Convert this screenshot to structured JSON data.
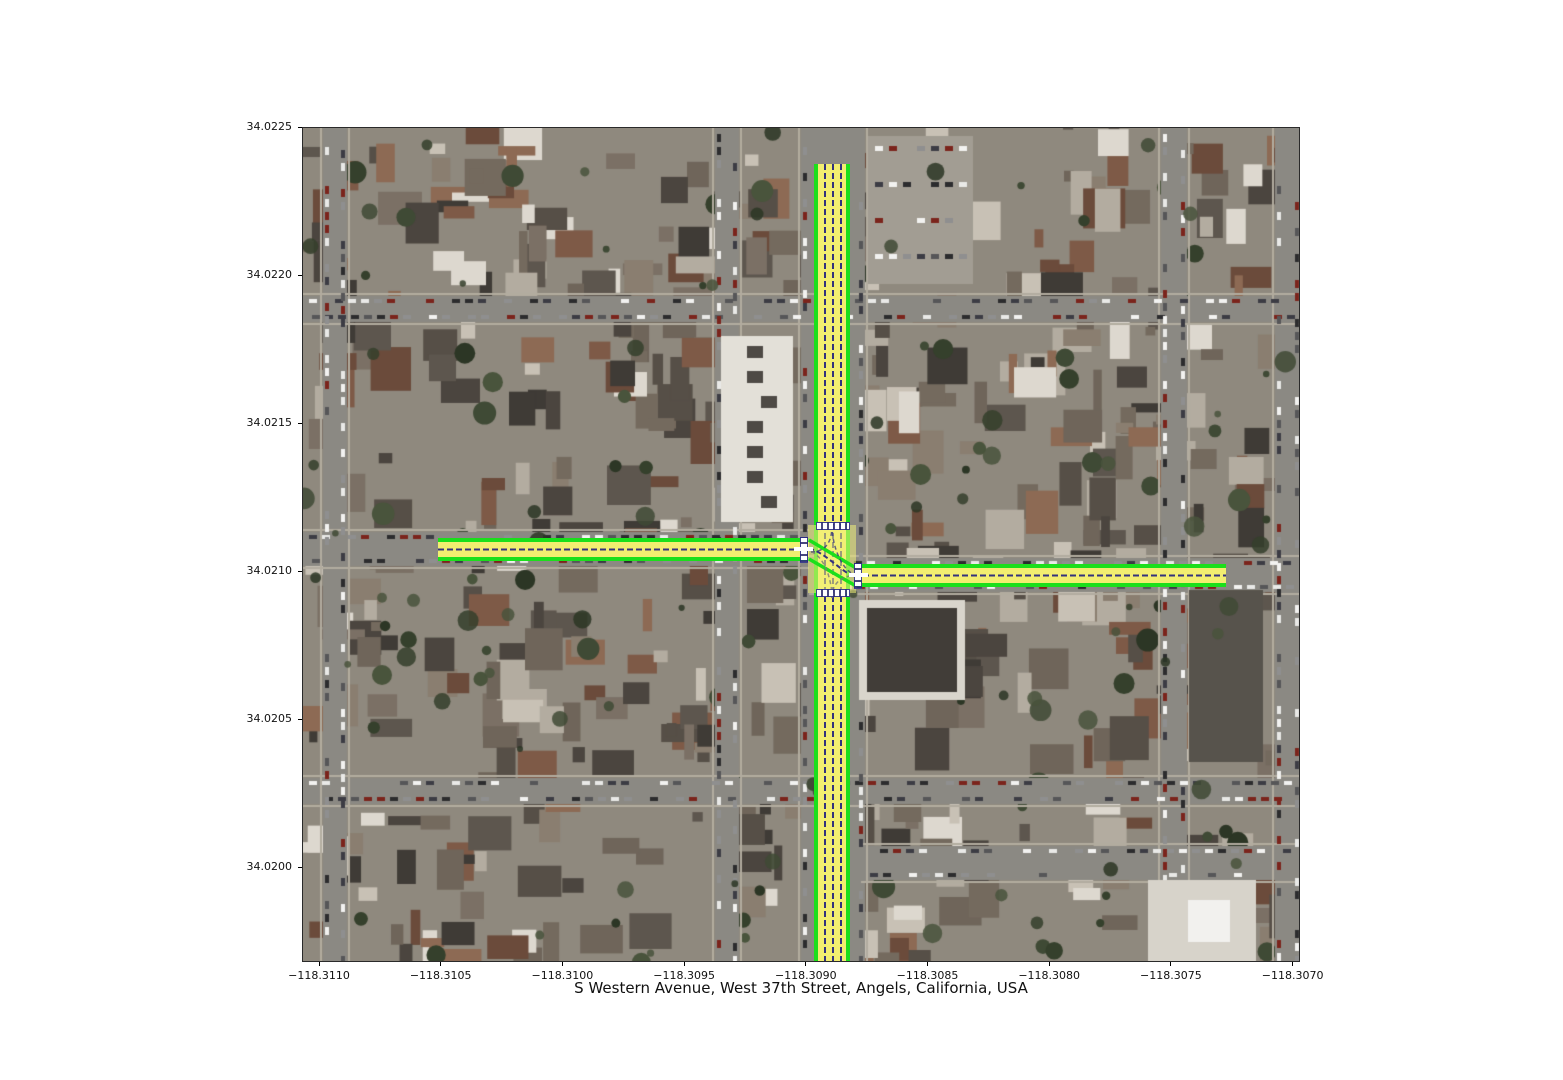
{
  "figure": {
    "title": "S Western Avenue, West 37th Street, Angels, California, USA",
    "x_axis": {
      "ticks": [
        "−118.3110",
        "−118.3105",
        "−118.3100",
        "−118.3095",
        "−118.3090",
        "−118.3085",
        "−118.3080",
        "−118.3075",
        "−118.3070"
      ],
      "range": [
        -118.31107,
        -118.30697
      ]
    },
    "y_axis": {
      "ticks": [
        "34.0225",
        "34.0220",
        "34.0215",
        "34.0210",
        "34.0205",
        "34.0200"
      ],
      "range": [
        34.01968,
        34.0225
      ]
    }
  },
  "map_overlay": {
    "type": "road-lane-annotation",
    "colors": {
      "road_edge": "#1bdf1b",
      "lane_fill": "#f2ee70",
      "lane_divider": "#32327d",
      "stop_marking": "#ffffff"
    },
    "features": [
      {
        "name": "S Western Avenue",
        "orientation": "vertical",
        "lon_center": -118.3089,
        "lat_span": [
          34.0197,
          34.0224
        ],
        "lane_lines": 4
      },
      {
        "name": "West 37th Street (west approach)",
        "orientation": "horizontal",
        "lat_center": 34.0211,
        "lon_span": [
          -118.31052,
          -118.30899
        ],
        "lane_lines": 2
      },
      {
        "name": "West 37th Street (east approach)",
        "orientation": "horizontal",
        "lat_center": 34.021,
        "lon_span": [
          -118.30881,
          -118.30728
        ],
        "lane_lines": 2
      }
    ]
  }
}
